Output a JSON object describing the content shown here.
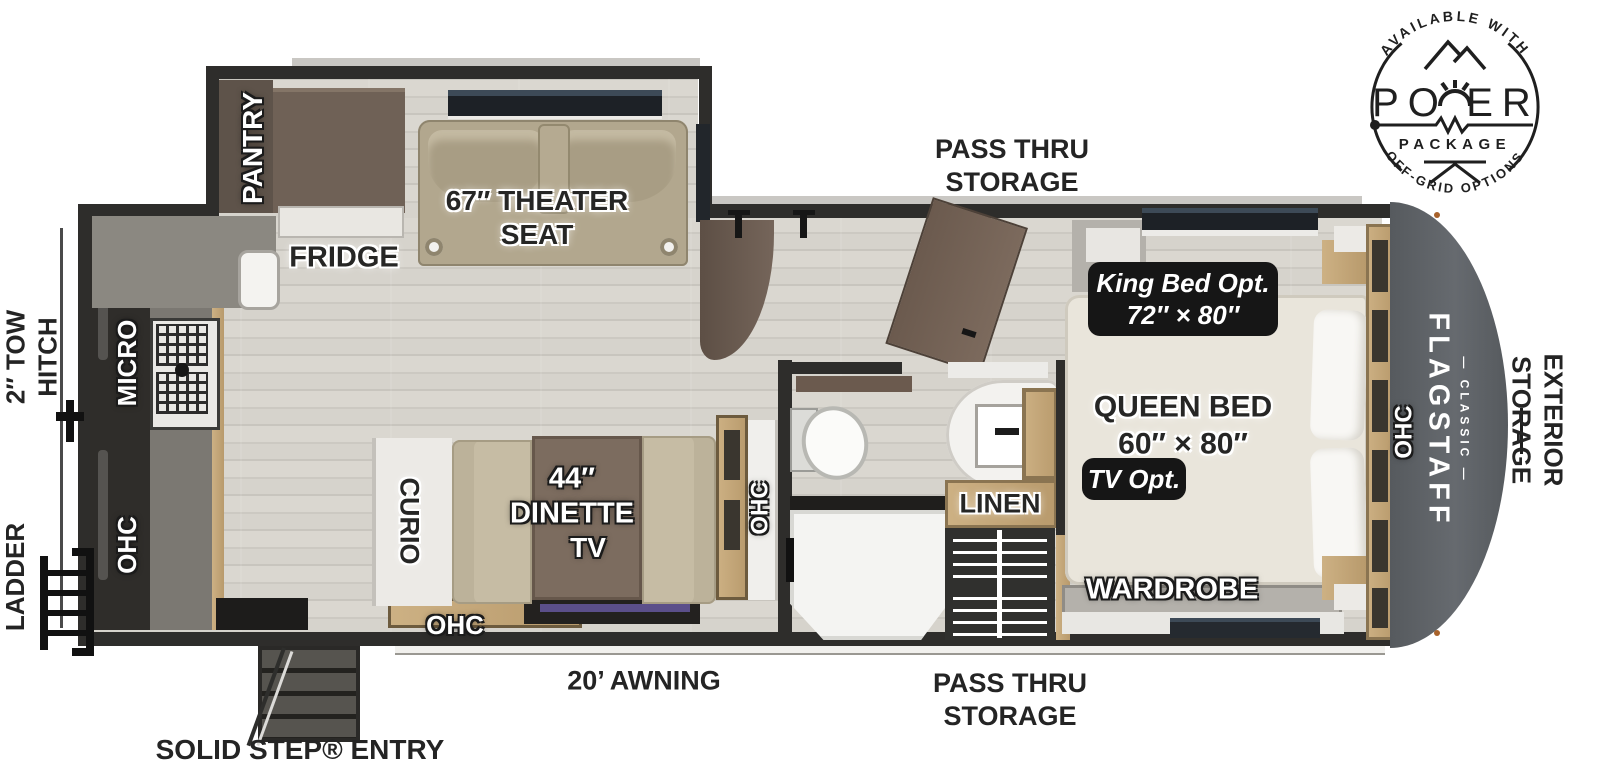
{
  "logo": {
    "arc_top": "AVAILABLE WITH",
    "title": "POWER",
    "subtitle": "PACKAGE",
    "arc_bottom": "OFF-GRID OPTIONS"
  },
  "exterior": {
    "pass_thru_top": {
      "l1": "PASS THRU",
      "l2": "STORAGE"
    },
    "pass_thru_bottom": {
      "l1": "PASS THRU",
      "l2": "STORAGE"
    },
    "awning": "20’ AWNING",
    "solid_step": "SOLID STEP® ENTRY",
    "tow_hitch": {
      "l1": "2″ TOW",
      "l2": "HITCH"
    },
    "ladder": "LADDER",
    "exterior_storage": {
      "l1": "EXTERIOR",
      "l2": "STORAGE"
    }
  },
  "interior": {
    "pantry": "PANTRY",
    "fridge": "FRIDGE",
    "theater": {
      "l1": "67″ THEATER",
      "l2": "SEAT"
    },
    "micro": "MICRO",
    "ohc_kitchen": "OHC",
    "curio": "CURIO",
    "dinette": {
      "l1": "44″",
      "l2": "DINETTE"
    },
    "tv": "TV",
    "ohc_dinette": "OHC",
    "ohc_hall": "OHC",
    "linen": "LINEN",
    "queen": {
      "l1": "QUEEN BED",
      "l2": "60″ × 80″"
    },
    "king_opt": {
      "l1": "King Bed Opt.",
      "l2": "72″ × 80″"
    },
    "tv_opt": "TV Opt.",
    "wardrobe": "WARDROBE",
    "ohc_bed": "OHC",
    "brand": {
      "name": "FLAGSTAFF",
      "series": "— CLASSIC —"
    }
  },
  "colors": {
    "ink": "#242424",
    "wall": "#2e2d2b",
    "floor": "#d6d3cc",
    "front_cap": "#5b5f64",
    "wood_trim": "#c3a87c",
    "cabinet_brown": "#6f6156",
    "theater_seat_tan": "#b2a78e",
    "bench_beige": "#c6bca4",
    "table_brown": "#7c6c5f",
    "tv_screen": "#5b4f8a"
  }
}
